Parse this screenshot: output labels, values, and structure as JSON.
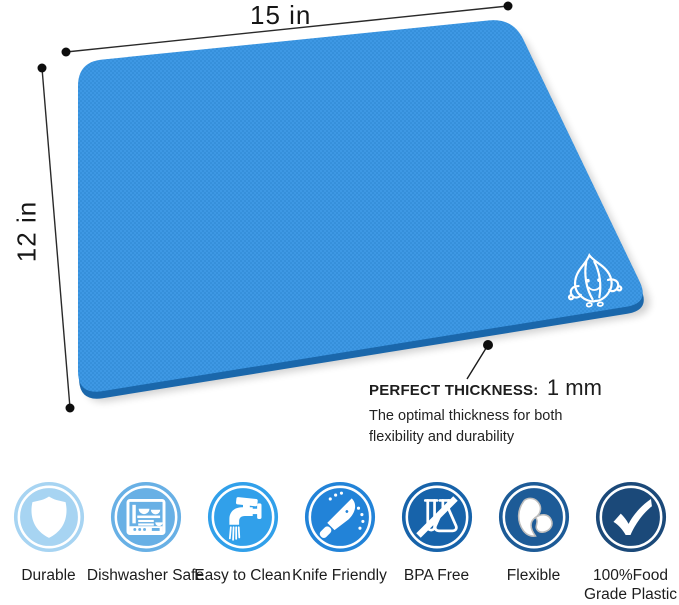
{
  "dimensions": {
    "width_label": "15 in",
    "height_label": "12 in"
  },
  "callout": {
    "title": "PERFECT THICKNESS:",
    "value": "1 mm",
    "description_line1": "The optimal thickness for both",
    "description_line2": "flexibility and durability"
  },
  "mat": {
    "name": "blue flexible cutting mat",
    "surface_color": "#3b96e2",
    "texture_dot_color": "#2e86d0",
    "edge_color": "#1a67ab",
    "logo": "garlic-logo"
  },
  "features": [
    {
      "label": "Durable",
      "icon": "shield-icon",
      "color": "#a7d4f2"
    },
    {
      "label": "Dishwasher Safe",
      "icon": "dishwasher-icon",
      "color": "#68b0e5"
    },
    {
      "label": "Easy to Clean",
      "icon": "faucet-icon",
      "color": "#31a0ea"
    },
    {
      "label": "Knife Friendly",
      "icon": "knife-icon",
      "color": "#2283d8"
    },
    {
      "label": "BPA Free",
      "icon": "no-bpa-flask-icon",
      "color": "#1763aa"
    },
    {
      "label": "Flexible",
      "icon": "flexible-sheet-icon",
      "color": "#1d5b97"
    },
    {
      "label": "100%Food Grade Plastic",
      "icon": "checkmark-icon",
      "color": "#1b4979"
    }
  ]
}
